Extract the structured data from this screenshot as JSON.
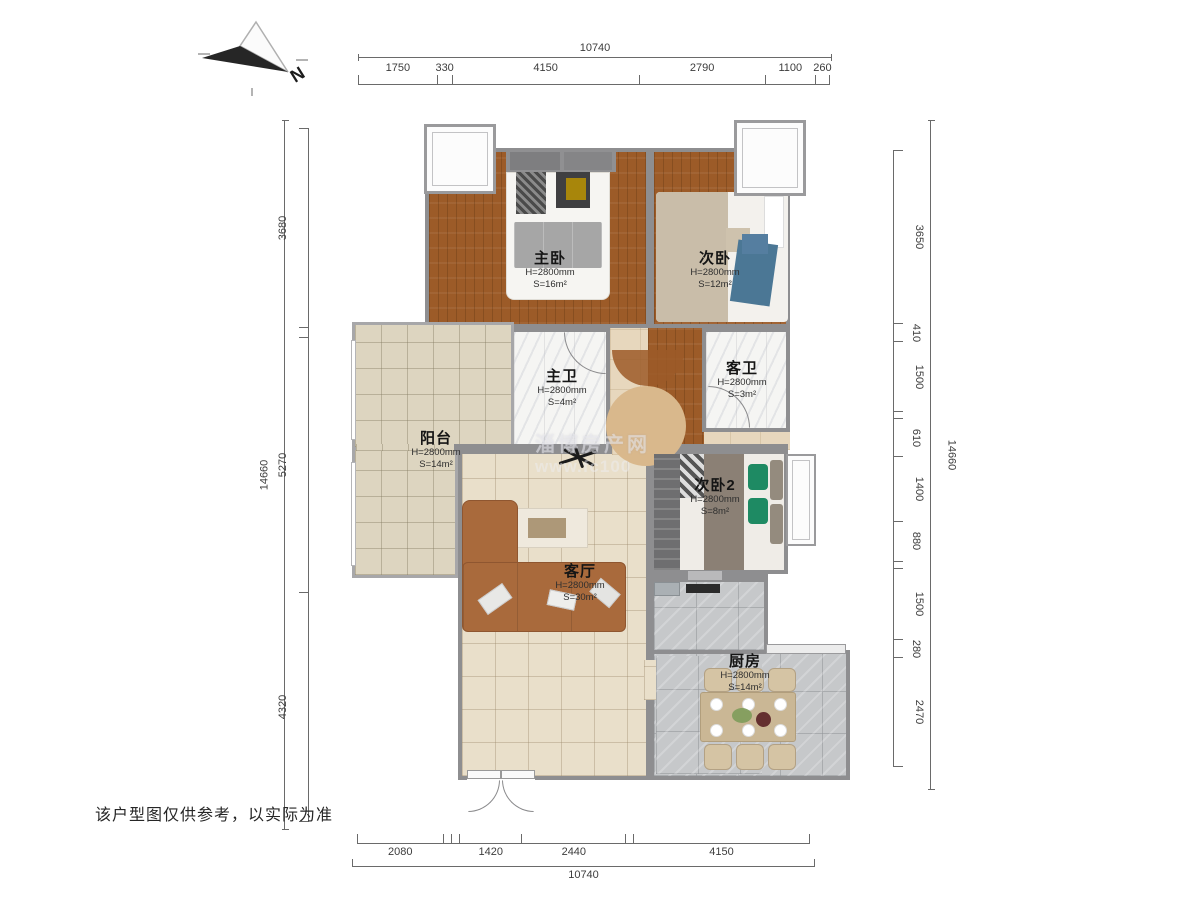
{
  "disclaimer": "该户型图仅供参考，以实际为准",
  "compass": {
    "label": "N"
  },
  "watermark": {
    "line1": "淄博房产网",
    "line2": "www.fc100"
  },
  "rooms": {
    "master_bedroom": {
      "name": "主卧",
      "height": "H=2800mm",
      "area": "S=16m²"
    },
    "second_bedroom": {
      "name": "次卧",
      "height": "H=2800mm",
      "area": "S=12m²"
    },
    "master_bath": {
      "name": "主卫",
      "height": "H=2800mm",
      "area": "S=4m²"
    },
    "guest_bath": {
      "name": "客卫",
      "height": "H=2800mm",
      "area": "S=3m²"
    },
    "balcony": {
      "name": "阳台",
      "height": "H=2800mm",
      "area": "S=14m²"
    },
    "second_bedroom_2": {
      "name": "次卧2",
      "height": "H=2800mm",
      "area": "S=8m²"
    },
    "living_room": {
      "name": "客厅",
      "height": "H=2800mm",
      "area": "S=30m²"
    },
    "kitchen": {
      "name": "厨房",
      "height": "H=2800mm",
      "area": "S=14m²"
    }
  },
  "dimensions": {
    "top_total": "10740",
    "bottom_total": "10740",
    "left_total": "14660",
    "right_total": "14660",
    "top_segments": [
      {
        "label": "1750",
        "frac": 0.167
      },
      {
        "label": "330",
        "frac": 0.03
      },
      {
        "label": "4150",
        "frac": 0.4
      },
      {
        "label": "2790",
        "frac": 0.269
      },
      {
        "label": "1100",
        "frac": 0.106
      },
      {
        "label": "260",
        "frac": 0.028
      }
    ],
    "bottom_segments": [
      {
        "label": "2080",
        "frac": 0.19
      },
      {
        "label": "",
        "frac": 0.016
      },
      {
        "label": "",
        "frac": 0.017
      },
      {
        "label": "1420",
        "frac": 0.137
      },
      {
        "label": "2440",
        "frac": 0.232
      },
      {
        "label": "",
        "frac": 0.015
      },
      {
        "label": "4150",
        "frac": 0.393
      }
    ],
    "left_segments": [
      {
        "label": "3680",
        "frac": 0.288
      },
      {
        "label": "",
        "frac": 0.012
      },
      {
        "label": "5270",
        "frac": 0.369
      },
      {
        "label": "4320",
        "frac": 0.331
      }
    ],
    "right_segments": [
      {
        "label": "3650",
        "frac": 0.284
      },
      {
        "label": "410",
        "frac": 0.029
      },
      {
        "label": "1500",
        "frac": 0.113
      },
      {
        "label": "",
        "frac": 0.011
      },
      {
        "label": "610",
        "frac": 0.06
      },
      {
        "label": "1400",
        "frac": 0.107
      },
      {
        "label": "880",
        "frac": 0.063
      },
      {
        "label": "",
        "frac": 0.01
      },
      {
        "label": "1500",
        "frac": 0.117
      },
      {
        "label": "280",
        "frac": 0.028
      },
      {
        "label": "2470",
        "frac": 0.178
      }
    ]
  }
}
